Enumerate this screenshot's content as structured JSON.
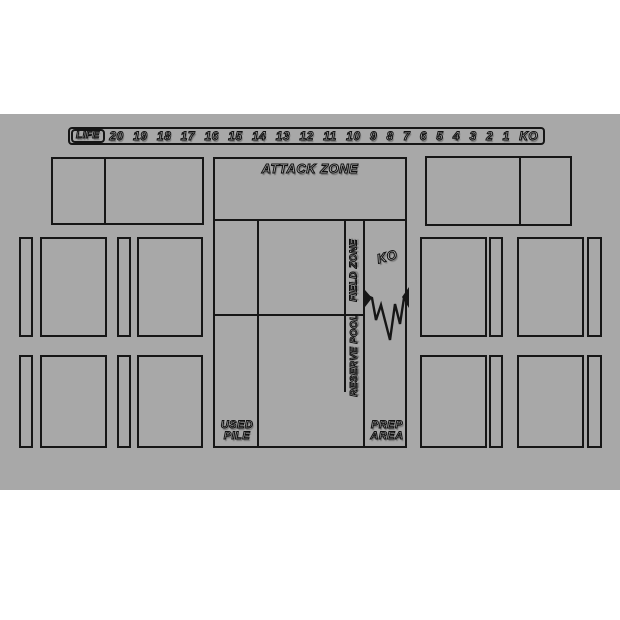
{
  "colors": {
    "background": "#ffffff",
    "mat": "#a8a8a8",
    "line": "#161616",
    "text_fill": "#b7b7b7",
    "text_outline": "#101010"
  },
  "life_track": {
    "label": "LIFE",
    "values": [
      "20",
      "19",
      "18",
      "17",
      "16",
      "15",
      "14",
      "13",
      "12",
      "11",
      "10",
      "9",
      "8",
      "7",
      "6",
      "5",
      "4",
      "3",
      "2",
      "1",
      "KO"
    ]
  },
  "zones": {
    "attack_zone": "ATTACK ZONE",
    "field_zone": "FIELD ZONE",
    "ko": "KO",
    "reserve_pool": "RESERVE POOL",
    "used_pile_line1": "USED",
    "used_pile_line2": "PILE",
    "prep_area_line1": "PREP",
    "prep_area_line2": "AREA"
  },
  "icons": {
    "tear": "explosion-tear"
  }
}
